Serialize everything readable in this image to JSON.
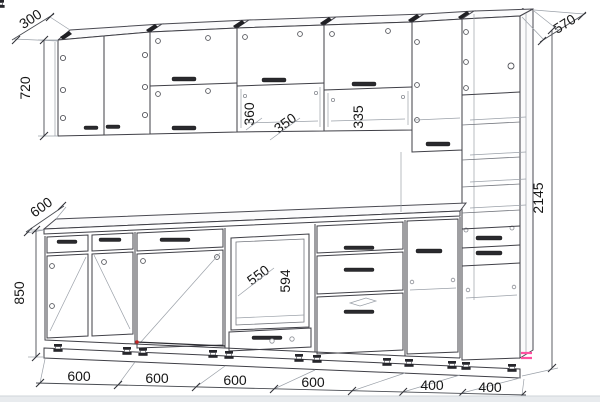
{
  "drawing": {
    "type": "kitchen-elevation-technical-drawing",
    "colors": {
      "background": "#ffffff",
      "line": "#3f3f46",
      "dimension_text": "#161616",
      "accent_red": "#8c1d1d",
      "accent_pink": "#ff4fa0",
      "footer_band": "#e8ebee"
    },
    "dims": {
      "wall_depth": "300",
      "wall_cab_height": "720",
      "counter_depth": "600",
      "base_height": "850",
      "tall_depth": "570",
      "total_height": "2145",
      "niche_open_height": "360",
      "niche_door_height": "350",
      "niche2_height": "335",
      "oven_niche_width": "550",
      "oven_niche_height": "594",
      "bottom_widths": [
        "600",
        "600",
        "600",
        "600",
        "400",
        "400"
      ]
    }
  }
}
